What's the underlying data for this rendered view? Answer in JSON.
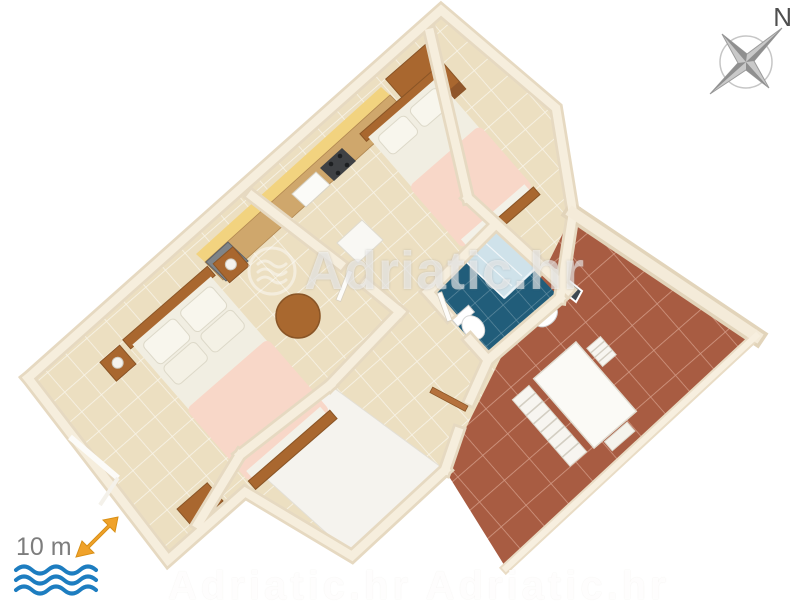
{
  "canvas": {
    "width": 800,
    "height": 600,
    "background": "#ffffff"
  },
  "compass": {
    "label": "N",
    "star_color": "#9b9b9b",
    "label_color": "#4f4f4f"
  },
  "scale_indicator": {
    "distance_label": "10 m",
    "label_color": "#7d7d7d",
    "arrow_color": "#f0a22a",
    "waves_color": "#1d7dc0"
  },
  "watermark": {
    "brand": "Adriatic.hr"
  },
  "bottom_watermark": {
    "text": "Adriatic.hr Adriatic.hr"
  },
  "floor_plan": {
    "view": "3d-isometric-apartment",
    "rooms": [
      {
        "name": "bedroom-1",
        "floor": "beige-tiles",
        "furniture": [
          "double-bed-pink-blanket",
          "nightstand-with-lamp-left",
          "nightstand-with-lamp-right",
          "wood-cabinet"
        ]
      },
      {
        "name": "kitchen-dining",
        "floor": "beige-tiles",
        "furniture": [
          "kitchen-counter",
          "yellow-backsplash",
          "sink",
          "stove",
          "gray-appliance",
          "round-wood-table",
          "white-cabinet"
        ]
      },
      {
        "name": "bedroom-2",
        "floor": "beige-tiles",
        "furniture": [
          "double-bed-pink-blanket",
          "tall-wardrobe"
        ]
      },
      {
        "name": "bathroom",
        "floor": "blue-tiles",
        "furniture": [
          "corner-shower",
          "toilet",
          "washbasin",
          "mirror"
        ]
      },
      {
        "name": "hallway",
        "floor": "beige-tiles",
        "furniture": [
          "open-doors"
        ]
      },
      {
        "name": "lower-terrace",
        "floor": "white",
        "furniture": []
      },
      {
        "name": "terrace",
        "floor": "terracotta-tiles",
        "furniture": [
          "white-dining-table",
          "slatted-bench",
          "chair"
        ]
      }
    ],
    "colors": {
      "wall": "#e6d9c1",
      "wall_top": "#f6eedd",
      "beige_tile": "#ecdfc1",
      "terracotta_tile": "#a85c42",
      "bathroom_tile": "#215d7a",
      "shower": "#cfe2ea",
      "bed_blanket_pink": "#f8d7c8",
      "bed_sheet": "#f1eee2",
      "wood": "#a9672f",
      "counter_top": "#cfa76c",
      "backsplash_yellow": "#f2d37f",
      "appliance_gray": "#7f8488"
    }
  }
}
